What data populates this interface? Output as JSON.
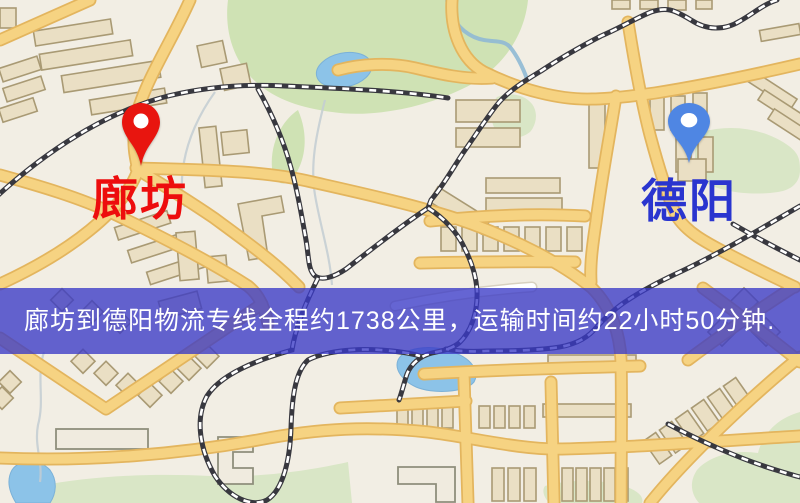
{
  "map": {
    "origin": {
      "label": "廊坊",
      "marker": "red-location-pin",
      "marker_color": "#e8150f",
      "label_color": "#ed0d0d"
    },
    "destination": {
      "label": "德阳",
      "marker": "blue-location-pin",
      "marker_color": "#4f86e3",
      "label_color": "#2a35cf"
    },
    "banner": {
      "text": "廊坊到德阳物流专线全程约1738公里，运输时间约22小时50分钟.",
      "background": "rgba(58,58,198,0.78)",
      "text_color": "#ffffff"
    }
  },
  "palette": {
    "land": "#f2eee4",
    "road_fill": "#f6d382",
    "road_casing": "#e3b55e",
    "water": "#8cc3e8",
    "park": "#cfe2b4",
    "building": "#eadfc4",
    "building_stroke": "#a99a74",
    "railway": "#38383f"
  }
}
